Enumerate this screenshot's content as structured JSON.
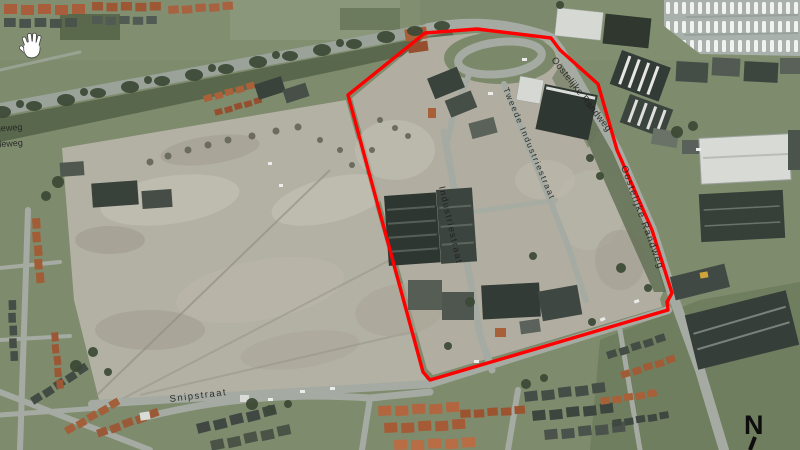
{
  "site_boundary": {
    "color": "#ff0000",
    "points": "348,95 425,33 477,29 551,38 560,50 598,84 617,150 652,230 672,293 667,302 668,310 430,380 423,372"
  },
  "street_labels": [
    {
      "name": "oostelijke-randweg-north",
      "text": "Oostelijke Randweg"
    },
    {
      "name": "oostelijke-randweg-east",
      "text": "Oostelijke Randweg"
    },
    {
      "name": "tweede-industriestraat",
      "text": "Tweede Industriestraat"
    },
    {
      "name": "industriestraat",
      "text": "Industriestraat"
    },
    {
      "name": "provincialeweg-clipped-1",
      "text": "ialeweg"
    },
    {
      "name": "provincialeweg-clipped-2",
      "text": "cialeweg"
    },
    {
      "name": "snipstraat",
      "text": "Snipstraat"
    }
  ],
  "north_indicator": {
    "text": "N"
  },
  "cursor": {
    "type": "open-hand-pan-cursor"
  }
}
